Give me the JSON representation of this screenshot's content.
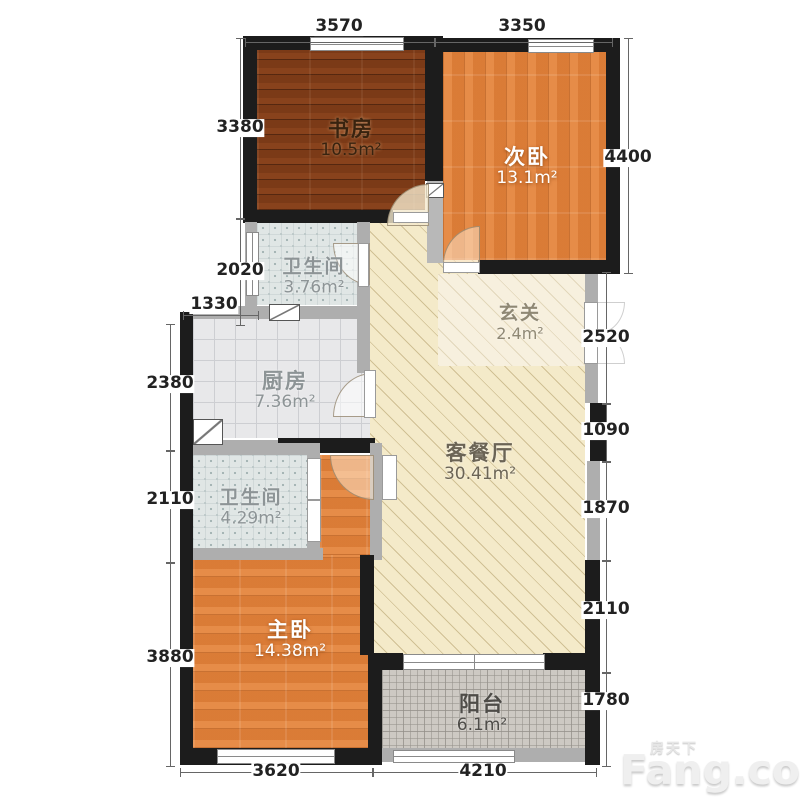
{
  "watermark": {
    "cn": "房天下",
    "en": "Fang.com"
  },
  "rooms": {
    "study": {
      "name": "书房",
      "area": "10.5m²"
    },
    "bedroom2": {
      "name": "次卧",
      "area": "13.1m²"
    },
    "bath1": {
      "name": "卫生间",
      "area": "3.76m²"
    },
    "kitchen": {
      "name": "厨房",
      "area": "7.36m²"
    },
    "foyer": {
      "name": "玄关",
      "area": "2.4m²"
    },
    "living": {
      "name": "客餐厅",
      "area": "30.41m²"
    },
    "bath2": {
      "name": "卫生间",
      "area": "4.29m²"
    },
    "master": {
      "name": "主卧",
      "area": "14.38m²"
    },
    "balcony": {
      "name": "阳台",
      "area": "6.1m²"
    }
  },
  "dimensions": {
    "top": [
      "3570",
      "3350"
    ],
    "left": [
      "3380",
      "2020",
      "1330",
      "2380",
      "2110",
      "3880"
    ],
    "right": [
      "4400",
      "2520",
      "1090",
      "1870",
      "2110",
      "1780"
    ],
    "bottom": [
      "3620",
      "4210"
    ]
  },
  "colors": {
    "wall": "#1c1c1c",
    "wall_light": "#aeaeae",
    "wood_dark": "#7b3a17",
    "wood_orange": "#e2813a",
    "living_floor": "#f4eac9",
    "bath_tile": "#e0e6e5",
    "kitchen_tile": "#e8e8ea",
    "balcony_tile": "#cdc9c3"
  }
}
